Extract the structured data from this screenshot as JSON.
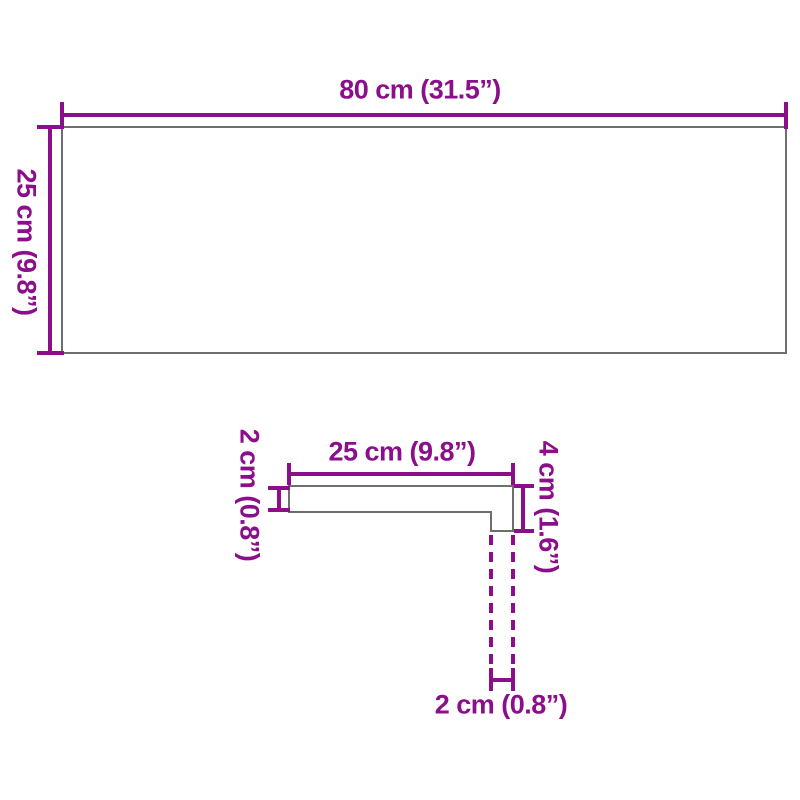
{
  "colors": {
    "dimension_accent": "#8B0E8B",
    "shape_outline": "#6E6E6E",
    "background": "#FFFFFF"
  },
  "top_view": {
    "width_label": "80 cm (31.5”)",
    "height_label": "25 cm (9.8”)"
  },
  "cross_section": {
    "width_label": "25 cm (9.8”)",
    "thickness_label": "2 cm (0.8”)",
    "height_label": "4 cm (1.6”)",
    "nose_label": "2 cm (0.8”)"
  }
}
